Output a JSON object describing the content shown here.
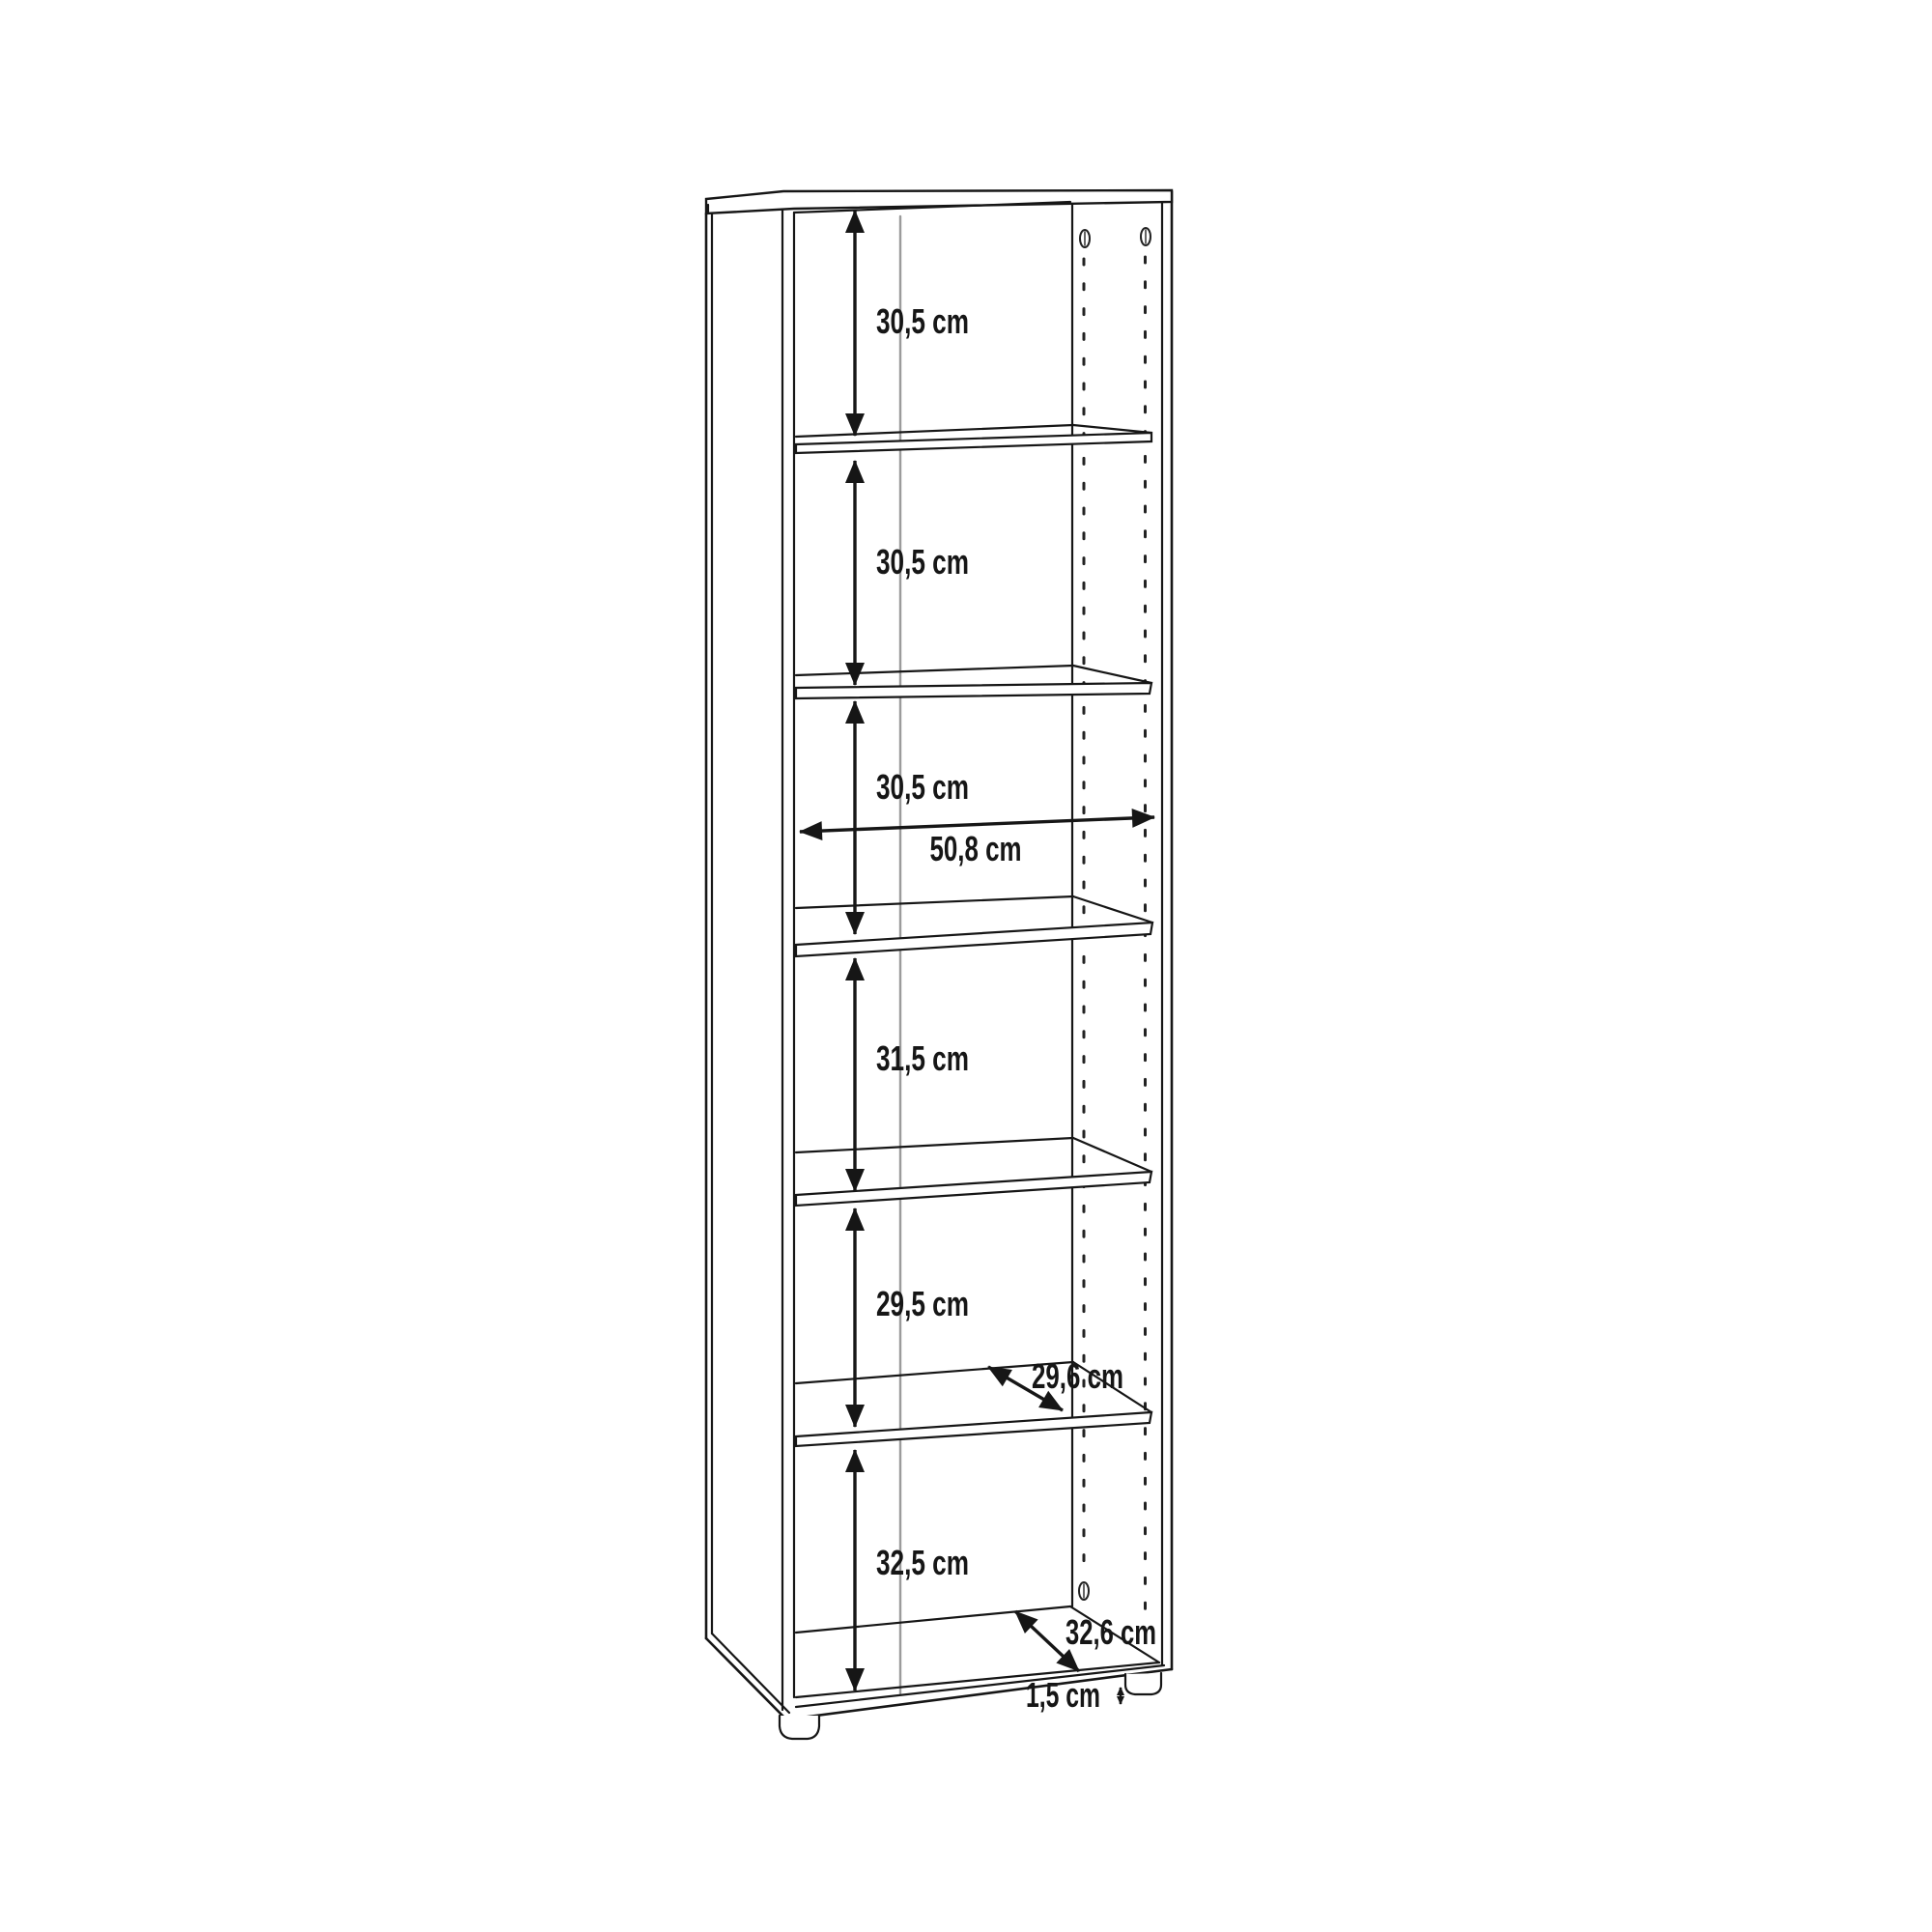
{
  "diagram": {
    "labels": {
      "compartments": [
        "30,5 cm",
        "30,5 cm",
        "30,5 cm",
        "31,5 cm",
        "29,5 cm",
        "32,5 cm"
      ],
      "inner_width": "50,8 cm",
      "shelf_depth": "29,6 cm",
      "bottom_depth": "32,6 cm",
      "foot_height": "1,5 cm"
    },
    "line_colors": {
      "outline": "#161616",
      "back_corner": "#9b9b9b",
      "peg_hole": "#222222"
    }
  }
}
